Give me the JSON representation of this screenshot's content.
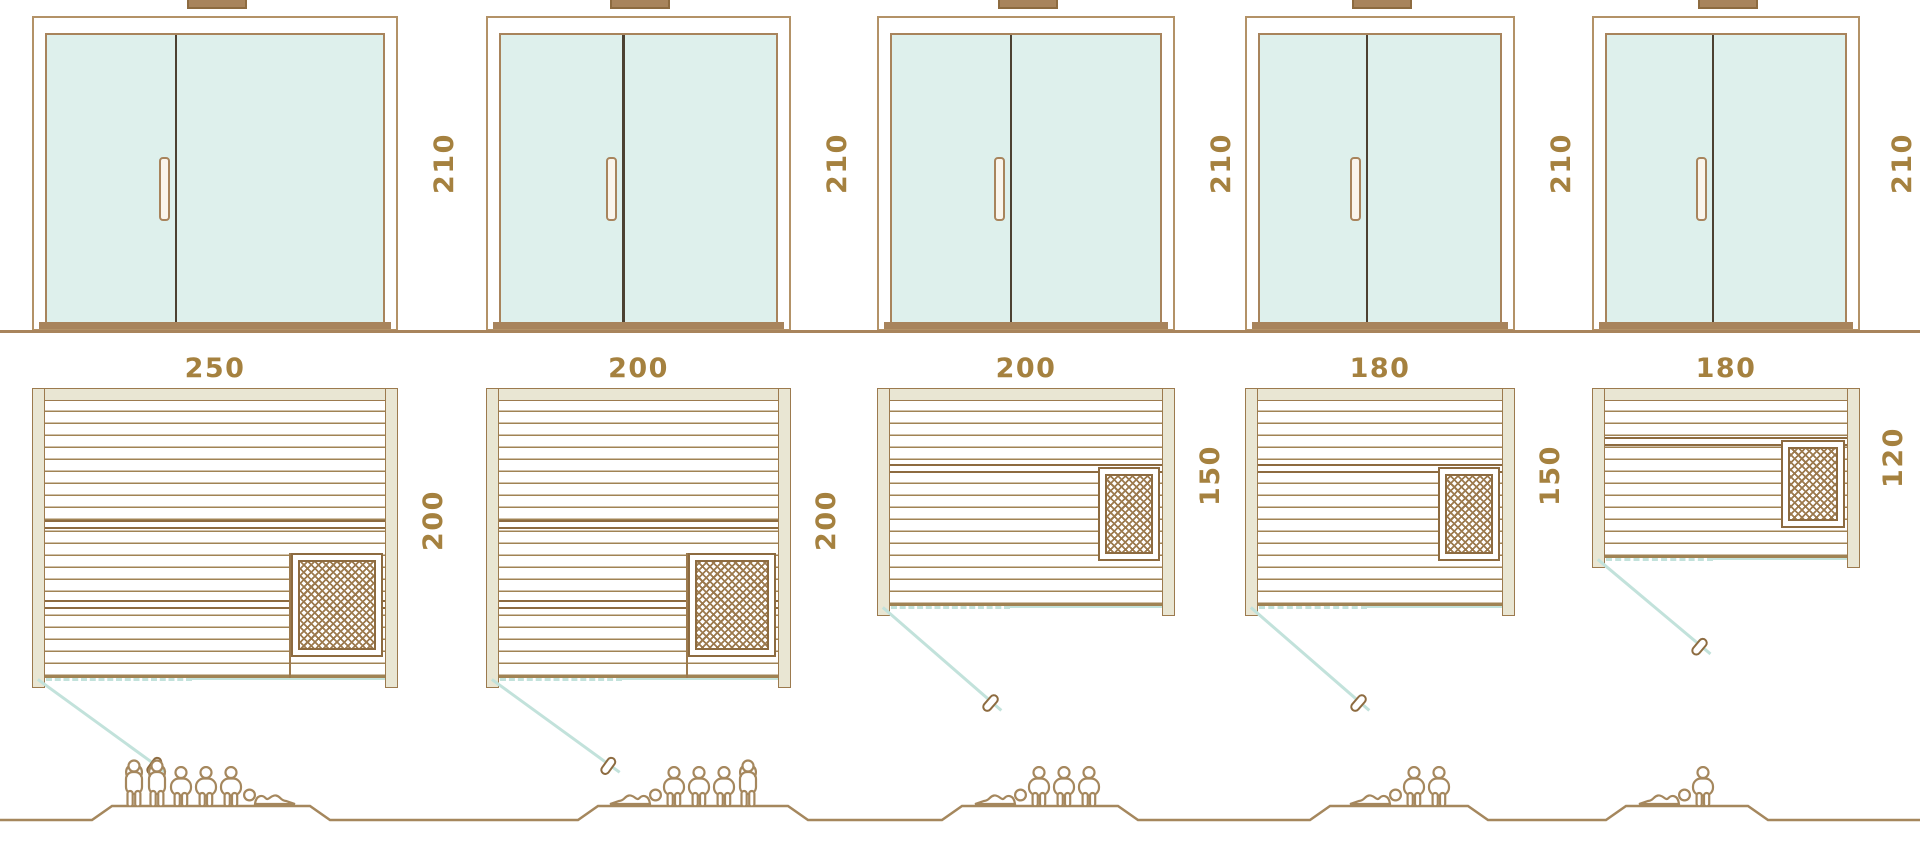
{
  "colors": {
    "outline_brown": "#9c7a4e",
    "dark_brown": "#8d6b40",
    "text_brown": "#a5813f",
    "wall_fill": "#e9e6d3",
    "glass_teal": "#def0ec",
    "swing_teal": "#c2e2db",
    "figure_tan": "#a5875d",
    "door_divider_dark": "#4c4132",
    "frame_tan": "#b39267"
  },
  "units": [
    {
      "door_height_cm": "210",
      "plan_width_cm": "250",
      "plan_depth_cm": "200",
      "capacity": {
        "standing": 2,
        "sitting": 3,
        "lying": 1,
        "total": 6
      },
      "arrangement": [
        "standing",
        "standing",
        "sitting",
        "sitting",
        "sitting",
        "lying-right"
      ]
    },
    {
      "door_height_cm": "210",
      "plan_width_cm": "200",
      "plan_depth_cm": "200",
      "capacity": {
        "standing": 1,
        "sitting": 3,
        "lying": 1,
        "total": 5
      },
      "arrangement": [
        "lying-left",
        "sitting",
        "sitting",
        "sitting",
        "standing"
      ]
    },
    {
      "door_height_cm": "210",
      "plan_width_cm": "200",
      "plan_depth_cm": "150",
      "capacity": {
        "standing": 0,
        "sitting": 3,
        "lying": 1,
        "total": 4
      },
      "arrangement": [
        "lying-left",
        "sitting",
        "sitting",
        "sitting"
      ]
    },
    {
      "door_height_cm": "210",
      "plan_width_cm": "180",
      "plan_depth_cm": "150",
      "capacity": {
        "standing": 0,
        "sitting": 2,
        "lying": 1,
        "total": 3
      },
      "arrangement": [
        "lying-left",
        "sitting",
        "sitting"
      ]
    },
    {
      "door_height_cm": "210",
      "plan_width_cm": "180",
      "plan_depth_cm": "120",
      "capacity": {
        "standing": 0,
        "sitting": 1,
        "lying": 1,
        "total": 2
      },
      "arrangement": [
        "lying-left",
        "sitting"
      ]
    }
  ]
}
